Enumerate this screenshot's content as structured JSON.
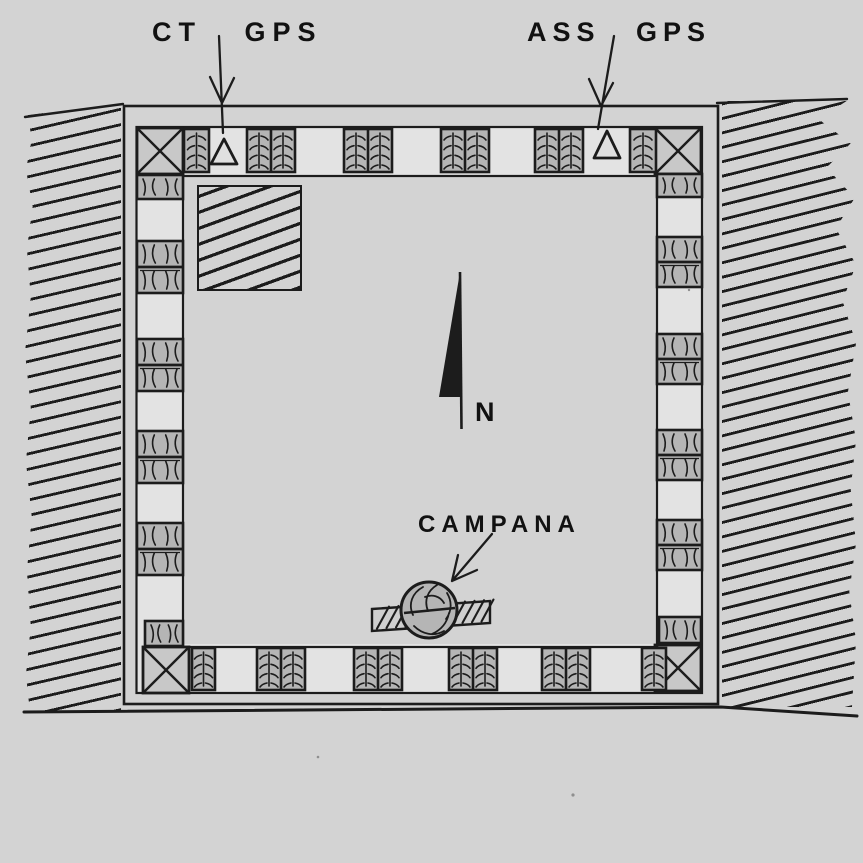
{
  "figure": {
    "description": "Hand-drawn archaeological site plan: square courtyard building with pier pairs along the walls, crossed corner blocks, GPS survey stations on the north wall, a bell (campana) near the south wall, north arrow, and hatched slope terrain outside the east and west walls",
    "labels": {
      "ct_gps": "CT GPS",
      "ass_gps": "ASS GPS",
      "campana": "CAMPANA",
      "north": "N"
    },
    "symbols": {
      "gps_station": "open-triangle-marker",
      "north_arrow": "half-filled-needle",
      "bell": "hatched-circle-on-hatched-bar",
      "corner_block": "square-with-diagonal-cross",
      "pier": "paired-hatched-squares",
      "terrain": "diagonal-slope-hatching"
    },
    "structure": {
      "pier_pairs_per_wall": 4,
      "corner_blocks": 4,
      "gps_stations": 2
    }
  },
  "colors": {
    "paper": "#d3d3d3",
    "ink": "#1c1c1c",
    "band_fill": "#e3e3e3",
    "block_fill": "#b5b5b5",
    "corner_fill": "#c8c8c8",
    "bar_fill": "#cfcfcf",
    "marker_fill": "#e0e0e0",
    "text": "#111111"
  }
}
